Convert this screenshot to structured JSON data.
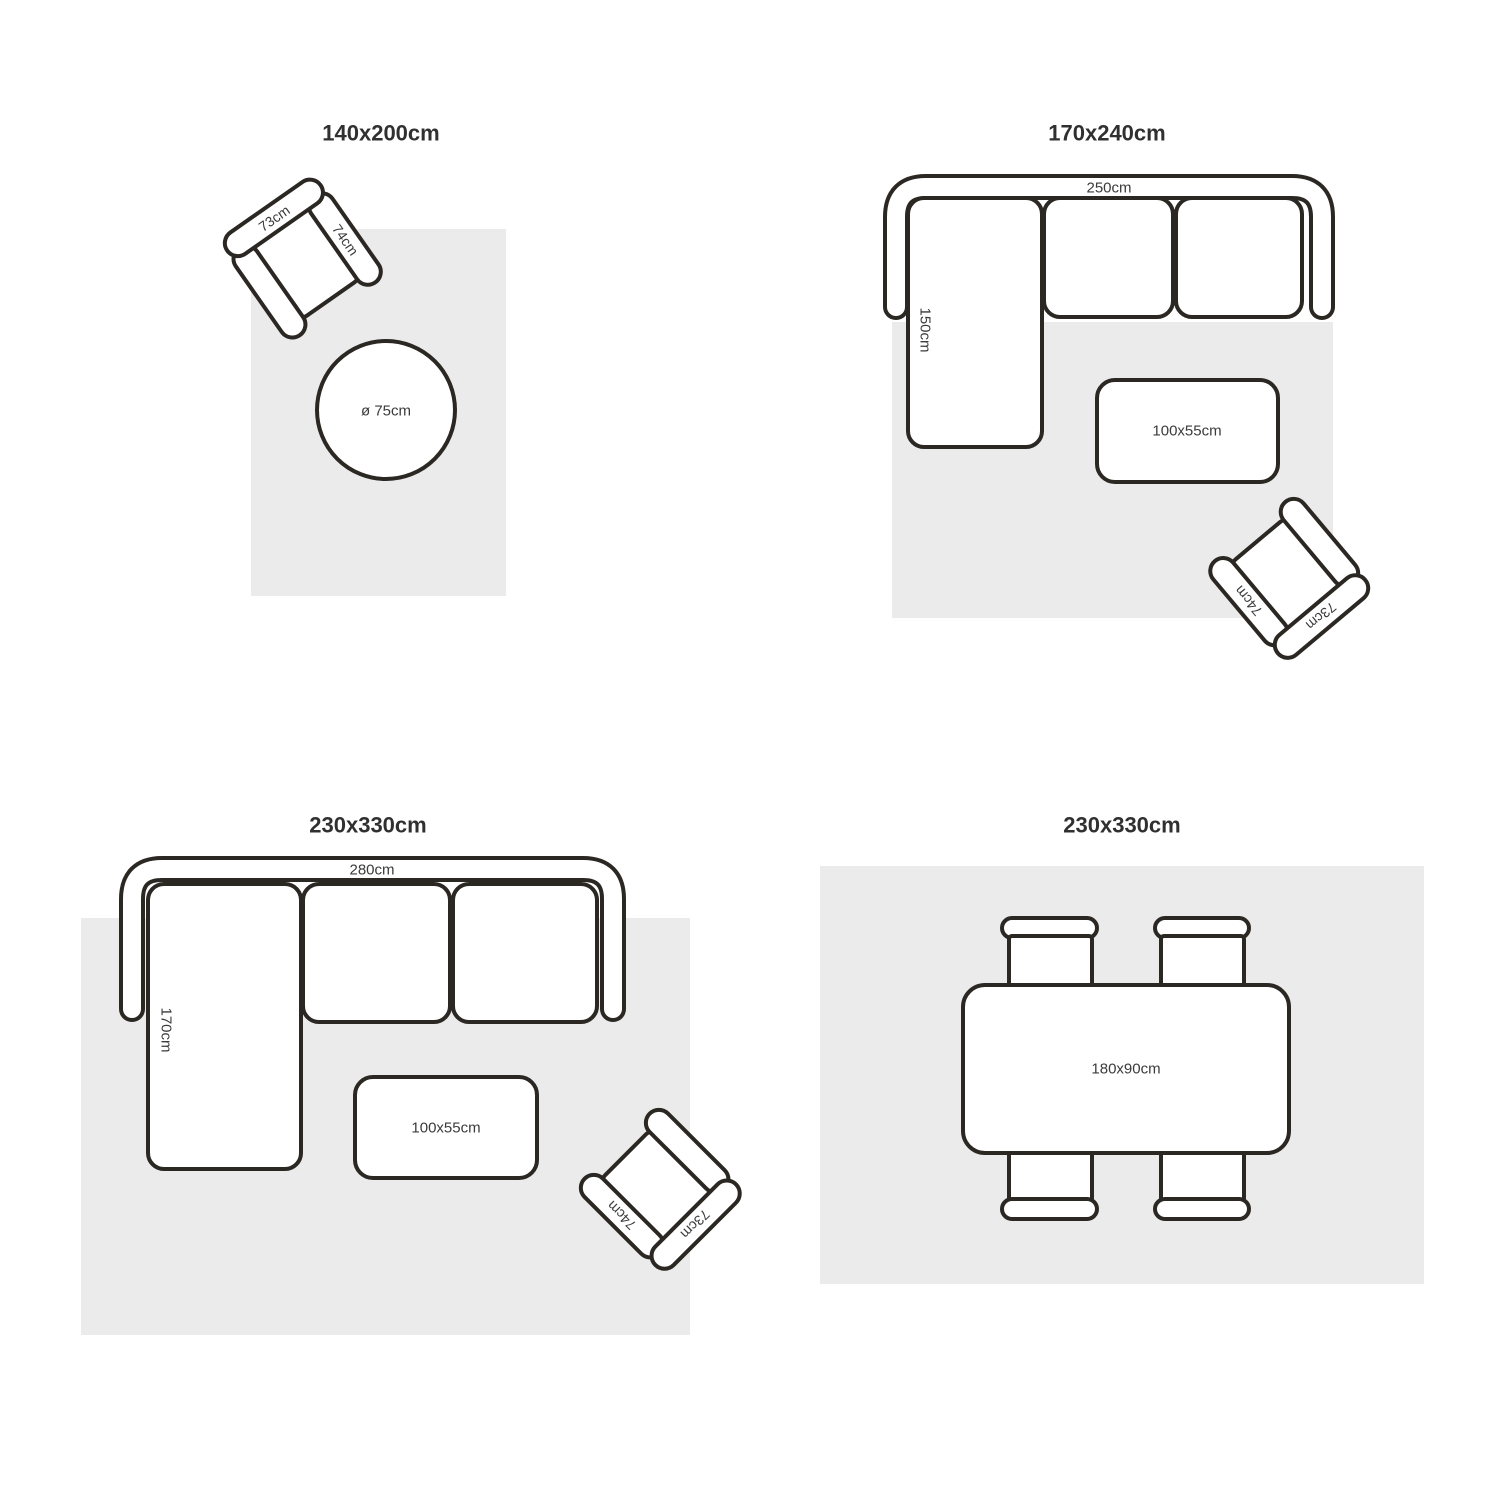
{
  "page": {
    "background_color": "#ffffff",
    "rug_color": "#ebebeb",
    "line_color": "#2b2723",
    "text_color": "#303030"
  },
  "quadrants": {
    "q1": {
      "title": "140x200cm",
      "armchair": {
        "back_label": "73cm",
        "arm_label": "74cm"
      },
      "round_table_label": "ø 75cm"
    },
    "q2": {
      "title": "170x240cm",
      "sofa": {
        "width_label": "250cm",
        "chaise_label": "150cm"
      },
      "coffee_table_label": "100x55cm",
      "armchair": {
        "back_label": "73cm",
        "arm_label": "74cm"
      }
    },
    "q3": {
      "title": "230x330cm",
      "sofa": {
        "width_label": "280cm",
        "chaise_label": "170cm"
      },
      "coffee_table_label": "100x55cm",
      "armchair": {
        "back_label": "73cm",
        "arm_label": "74cm"
      }
    },
    "q4": {
      "title": "230x330cm",
      "dining_table_label": "180x90cm"
    }
  }
}
